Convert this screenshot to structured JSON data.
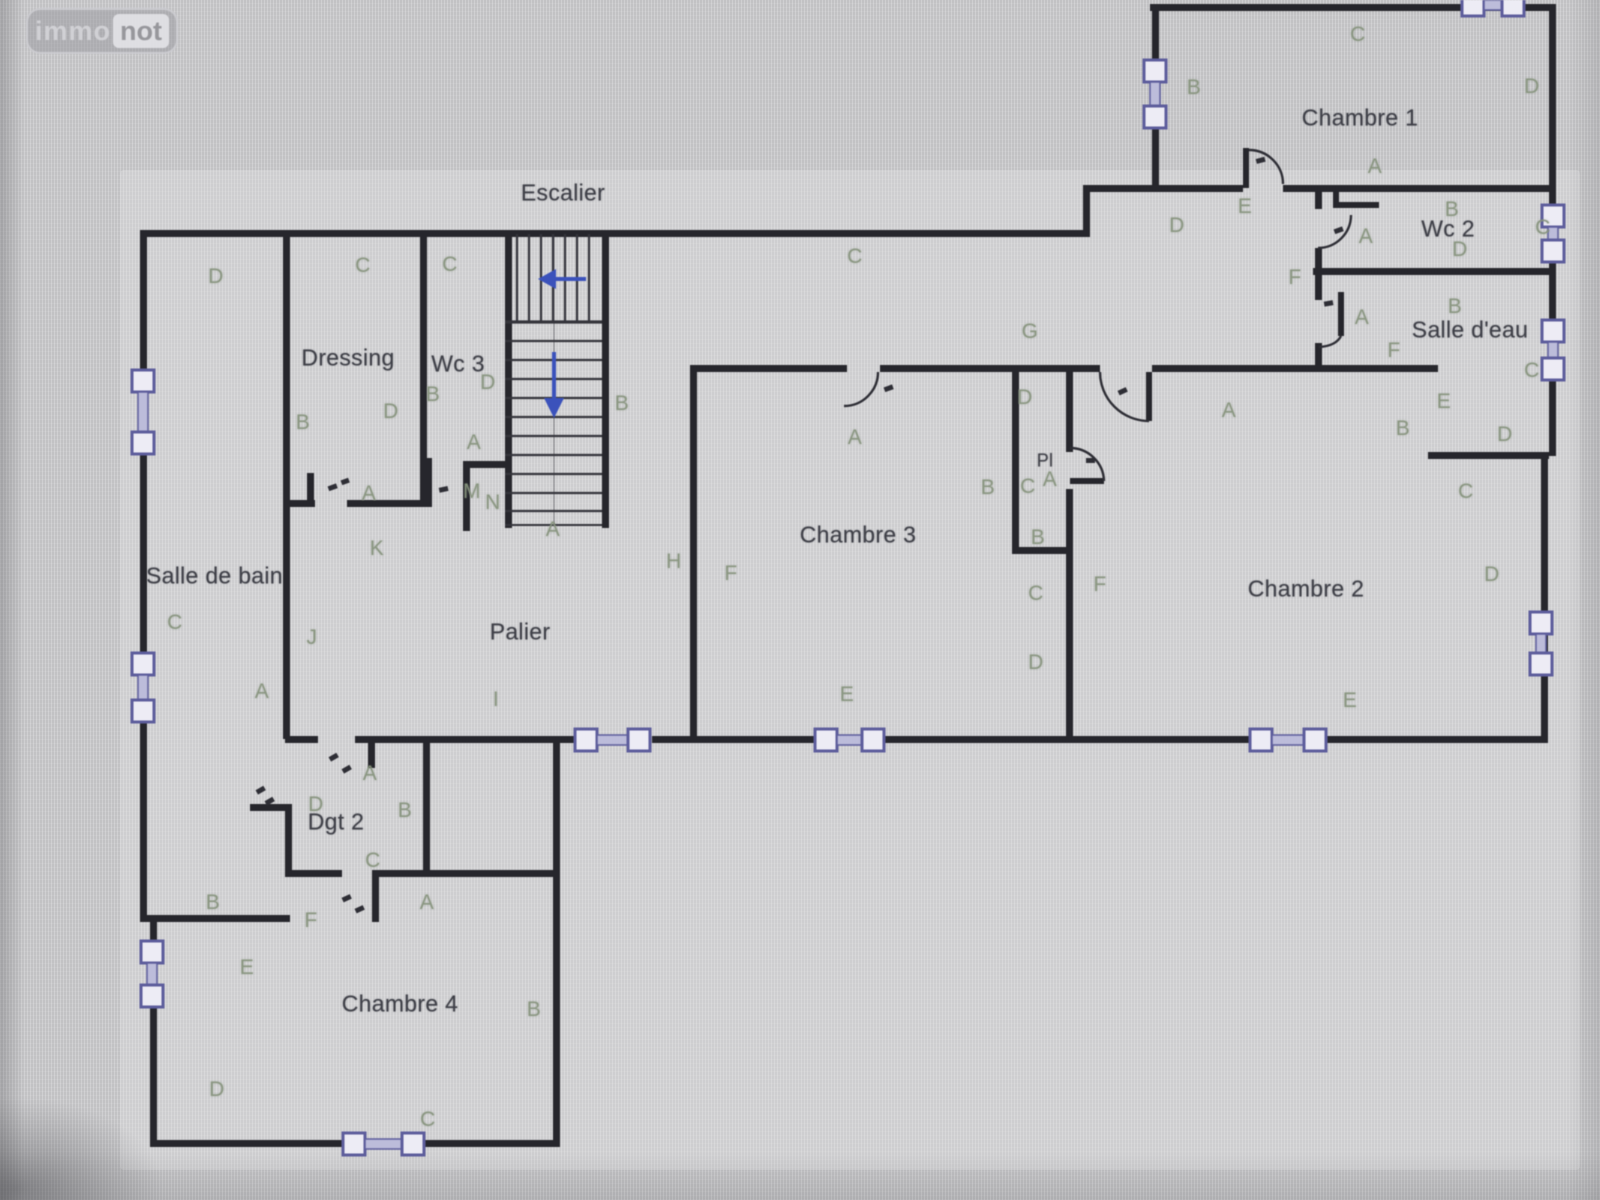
{
  "watermark": {
    "part1": "immo",
    "part2": "not"
  },
  "colors": {
    "background": "#c6c6c8",
    "wall": "#26262c",
    "letters": "#87947e",
    "room_text": "#3e3f47",
    "window_accent": "#5d5da1",
    "stair_arrow_blue": "#3952c4",
    "watermark_gray": "#9e9ea3"
  },
  "symbols": {
    "window": "window-symbol",
    "door": "door-arc-icon",
    "stair_up_arrow": "stair-arrow-left-icon",
    "stair_down_arrow": "stair-arrow-down-icon"
  },
  "floorplan": {
    "rooms": [
      {
        "name": "escalier",
        "label": "Escalier",
        "x": 563,
        "y": 193
      },
      {
        "name": "chambre-1",
        "label": "Chambre 1",
        "x": 1360,
        "y": 118
      },
      {
        "name": "wc-2",
        "label": "Wc 2",
        "x": 1448,
        "y": 229
      },
      {
        "name": "salle-d-eau",
        "label": "Salle d'eau",
        "x": 1470,
        "y": 330
      },
      {
        "name": "dressing",
        "label": "Dressing",
        "x": 348,
        "y": 358
      },
      {
        "name": "wc-3",
        "label": "Wc 3",
        "x": 458,
        "y": 364
      },
      {
        "name": "chambre-3",
        "label": "Chambre 3",
        "x": 858,
        "y": 535
      },
      {
        "name": "chambre-2",
        "label": "Chambre 2",
        "x": 1306,
        "y": 589
      },
      {
        "name": "salle-de-bain",
        "label": "Salle de bain",
        "x": 146,
        "y": 576,
        "align": "left",
        "w": 140
      },
      {
        "name": "palier",
        "label": "Palier",
        "x": 520,
        "y": 632
      },
      {
        "name": "degagement-2",
        "label": "Dgt 2",
        "x": 336,
        "y": 822
      },
      {
        "name": "placard",
        "label": "Pl",
        "x": 1045,
        "y": 461,
        "size": 18
      },
      {
        "name": "chambre-4",
        "label": "Chambre 4",
        "x": 400,
        "y": 1004
      }
    ],
    "wall_labels": [
      {
        "t": "D",
        "x": 216,
        "y": 277
      },
      {
        "t": "C",
        "x": 363,
        "y": 266
      },
      {
        "t": "C",
        "x": 450,
        "y": 265
      },
      {
        "t": "B",
        "x": 303,
        "y": 423
      },
      {
        "t": "D",
        "x": 391,
        "y": 412
      },
      {
        "t": "B",
        "x": 433,
        "y": 395
      },
      {
        "t": "D",
        "x": 488,
        "y": 383
      },
      {
        "t": "A",
        "x": 474,
        "y": 443
      },
      {
        "t": "A",
        "x": 369,
        "y": 494
      },
      {
        "t": "M",
        "x": 472,
        "y": 492
      },
      {
        "t": "N",
        "x": 493,
        "y": 503
      },
      {
        "t": "K",
        "x": 377,
        "y": 549
      },
      {
        "t": "B",
        "x": 622,
        "y": 404
      },
      {
        "t": "A",
        "x": 553,
        "y": 530
      },
      {
        "t": "C",
        "x": 175,
        "y": 623
      },
      {
        "t": "A",
        "x": 262,
        "y": 692
      },
      {
        "t": "J",
        "x": 312,
        "y": 638
      },
      {
        "t": "B",
        "x": 213,
        "y": 903
      },
      {
        "t": "E",
        "x": 247,
        "y": 968
      },
      {
        "t": "I",
        "x": 496,
        "y": 700
      },
      {
        "t": "H",
        "x": 674,
        "y": 562
      },
      {
        "t": "C",
        "x": 855,
        "y": 257
      },
      {
        "t": "G",
        "x": 1030,
        "y": 332
      },
      {
        "t": "D",
        "x": 1177,
        "y": 226
      },
      {
        "t": "E",
        "x": 1245,
        "y": 207
      },
      {
        "t": "F",
        "x": 1295,
        "y": 278
      },
      {
        "t": "C",
        "x": 1358,
        "y": 35
      },
      {
        "t": "B",
        "x": 1194,
        "y": 88
      },
      {
        "t": "D",
        "x": 1532,
        "y": 87
      },
      {
        "t": "A",
        "x": 1375,
        "y": 167
      },
      {
        "t": "A",
        "x": 1366,
        "y": 237
      },
      {
        "t": "B",
        "x": 1452,
        "y": 210
      },
      {
        "t": "D",
        "x": 1460,
        "y": 250
      },
      {
        "t": "C",
        "x": 1543,
        "y": 228
      },
      {
        "t": "A",
        "x": 1362,
        "y": 318
      },
      {
        "t": "B",
        "x": 1455,
        "y": 307
      },
      {
        "t": "F",
        "x": 1394,
        "y": 351
      },
      {
        "t": "C",
        "x": 1532,
        "y": 371
      },
      {
        "t": "E",
        "x": 1444,
        "y": 402
      },
      {
        "t": "D",
        "x": 1505,
        "y": 435
      },
      {
        "t": "B",
        "x": 1403,
        "y": 429
      },
      {
        "t": "C",
        "x": 1466,
        "y": 492
      },
      {
        "t": "A",
        "x": 855,
        "y": 438
      },
      {
        "t": "F",
        "x": 731,
        "y": 574
      },
      {
        "t": "E",
        "x": 847,
        "y": 695
      },
      {
        "t": "B",
        "x": 988,
        "y": 488
      },
      {
        "t": "D",
        "x": 1025,
        "y": 398
      },
      {
        "t": "C",
        "x": 1028,
        "y": 487
      },
      {
        "t": "A",
        "x": 1050,
        "y": 480
      },
      {
        "t": "B",
        "x": 1038,
        "y": 538
      },
      {
        "t": "C",
        "x": 1036,
        "y": 594
      },
      {
        "t": "D",
        "x": 1036,
        "y": 663
      },
      {
        "t": "A",
        "x": 1229,
        "y": 411
      },
      {
        "t": "F",
        "x": 1100,
        "y": 585
      },
      {
        "t": "D",
        "x": 1492,
        "y": 575
      },
      {
        "t": "E",
        "x": 1350,
        "y": 701
      },
      {
        "t": "A",
        "x": 370,
        "y": 774
      },
      {
        "t": "D",
        "x": 316,
        "y": 805
      },
      {
        "t": "B",
        "x": 405,
        "y": 811
      },
      {
        "t": "C",
        "x": 373,
        "y": 861
      },
      {
        "t": "F",
        "x": 311,
        "y": 921
      },
      {
        "t": "A",
        "x": 427,
        "y": 903
      },
      {
        "t": "D",
        "x": 217,
        "y": 1090
      },
      {
        "t": "C",
        "x": 428,
        "y": 1120
      },
      {
        "t": "B",
        "x": 534,
        "y": 1010
      }
    ]
  }
}
